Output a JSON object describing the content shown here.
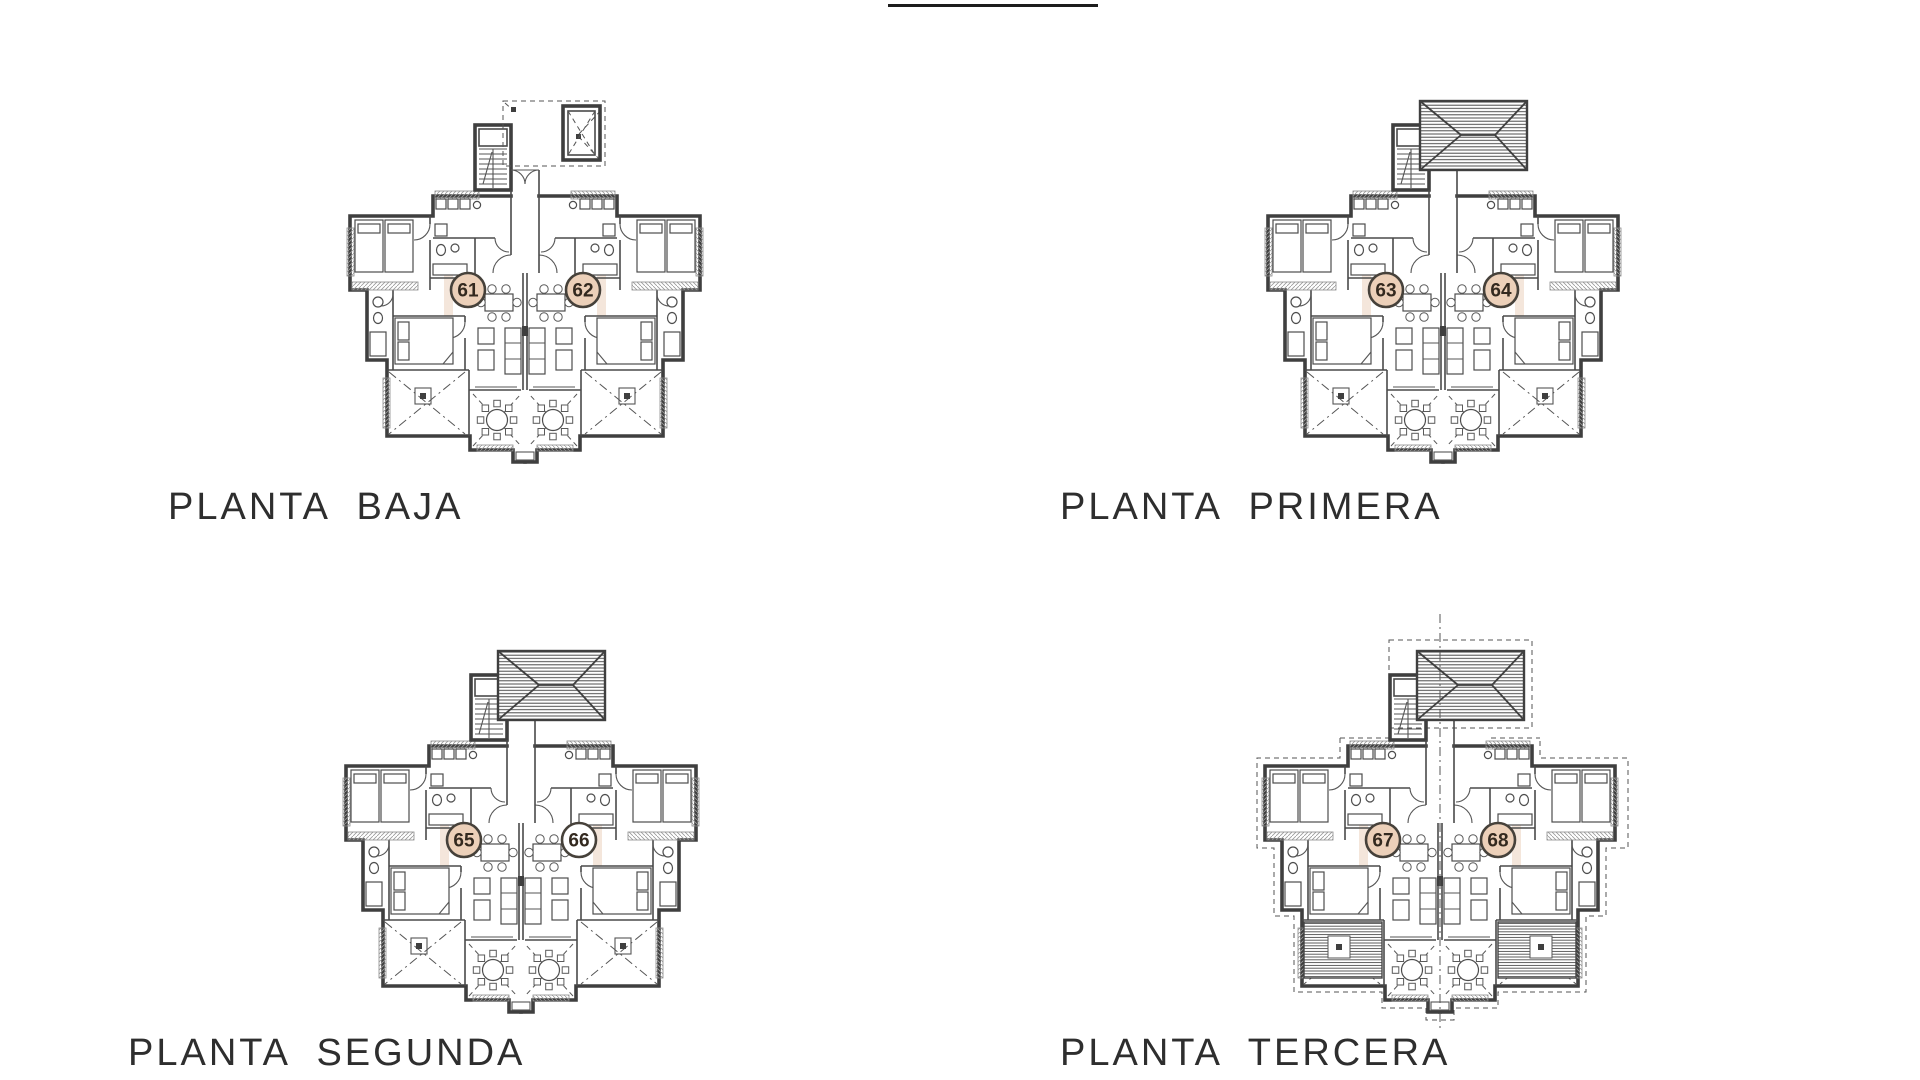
{
  "drawing": {
    "ink": "#3f3f3f",
    "badge_fill_peach": "#ecd0b9",
    "badge_fill_white": "#ffffff",
    "badge_stroke": "#46413a",
    "badge_text_color": "#33291f"
  },
  "plans": [
    {
      "label": "PLANTA BAJA",
      "variant": {
        "canopy_dashed": true,
        "roof_hatched": false,
        "outline_dashed": false,
        "balconies_hatched": false,
        "centerline": false
      },
      "units": [
        {
          "number": "61",
          "fill": "#ecd0b9"
        },
        {
          "number": "62",
          "fill": "#ecd0b9"
        }
      ]
    },
    {
      "label": "PLANTA PRIMERA",
      "variant": {
        "canopy_dashed": false,
        "roof_hatched": true,
        "outline_dashed": false,
        "balconies_hatched": false,
        "centerline": false
      },
      "units": [
        {
          "number": "63",
          "fill": "#ecd0b9"
        },
        {
          "number": "64",
          "fill": "#ecd0b9"
        }
      ]
    },
    {
      "label": "PLANTA SEGUNDA",
      "variant": {
        "canopy_dashed": false,
        "roof_hatched": true,
        "outline_dashed": false,
        "balconies_hatched": false,
        "centerline": false
      },
      "units": [
        {
          "number": "65",
          "fill": "#ecd0b9"
        },
        {
          "number": "66",
          "fill": "#ffffff"
        }
      ]
    },
    {
      "label": "PLANTA TERCERA",
      "variant": {
        "canopy_dashed": false,
        "roof_hatched": true,
        "outline_dashed": true,
        "balconies_hatched": true,
        "centerline": true
      },
      "units": [
        {
          "number": "67",
          "fill": "#ecd0b9"
        },
        {
          "number": "68",
          "fill": "#ecd0b9"
        }
      ]
    }
  ]
}
